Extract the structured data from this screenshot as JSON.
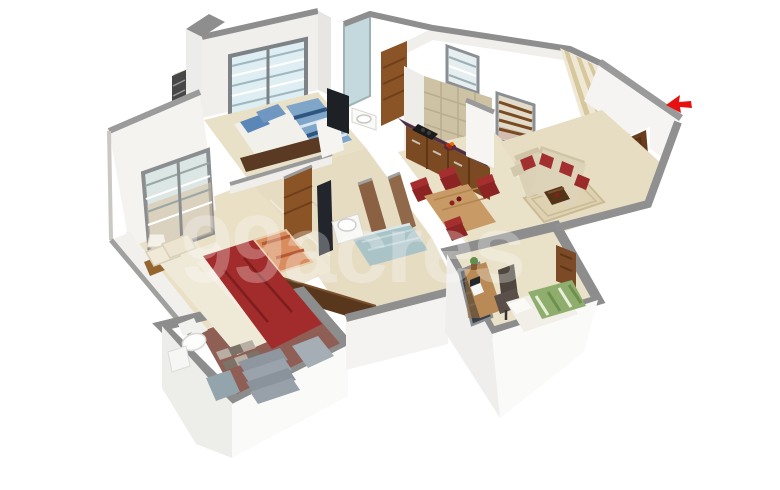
{
  "scene": {
    "description": "3D isometric rendered floor plan of a 2-3 BHK apartment on white background",
    "background": "#ffffff"
  },
  "watermark": {
    "text": "99acres",
    "color": "#ffffff",
    "opacity": "0.28"
  },
  "north_arrow": {
    "color": "#e81111",
    "direction": "left"
  },
  "palette": {
    "wall_top": "#8e8e8e",
    "wall_face": "#f2f1ee",
    "wall_bright": "#fafaf9",
    "floor_beige": "#e9e0c8",
    "floor_dark": "#e3d9bd",
    "wood_door": "#8a5426",
    "wood_dark": "#5a3820",
    "bed_red": "#a22b2b",
    "bed_blue": "#7fa6c9",
    "bed_green": "#8fae6d",
    "sofa_cream": "#dbd1b6",
    "cushion_red": "#a33030",
    "counter_top": "#4e2f40",
    "kitchen_tile": "#cdc2a3",
    "stripe_wall_a": "#efe8d4",
    "stripe_wall_b": "#d6c79c",
    "bath_teal": "#a9c3c6",
    "granite": "#98a1aa",
    "glass_blue": "#dfeef2"
  },
  "rooms": [
    {
      "name": "Bedroom 2",
      "furniture": [
        "double bed with blue striped bedding",
        "blue pillows",
        "TV on white unit",
        "louvered window",
        "balcony with dark railing",
        "washbasin counter"
      ]
    },
    {
      "name": "Kitchen",
      "furniture": [
        "counter with dark stone top",
        "gas stove",
        "fruit bowl",
        "wooden cabinets",
        "beige tiled wall",
        "utility window"
      ]
    },
    {
      "name": "Dining Area",
      "furniture": [
        "wooden four seat dining table",
        "red upholstered chairs"
      ]
    },
    {
      "name": "Living Room",
      "furniture": [
        "cream L-shaped sofa with red cushions",
        "coffee table",
        "rug",
        "striped wallpaper accent wall",
        "open wooden entrance door",
        "balcony window with brown louvers"
      ]
    },
    {
      "name": "Master Bedroom",
      "furniture": [
        "double bed with red blanket",
        "cream pillows",
        "bedside lamp",
        "orange rug",
        "louvered window",
        "wooden door",
        "low wardrobe ledge"
      ]
    },
    {
      "name": "Master Bathroom",
      "furniture": [
        "toilet",
        "checkered tile floor",
        "granite shower steps",
        "washing machine"
      ]
    },
    {
      "name": "Common Bathroom",
      "furniture": [
        "washbasin",
        "wall TV panel",
        "teal shower area",
        "wooden partition walls",
        "teal glass panel",
        "wooden slatted door"
      ]
    },
    {
      "name": "Study Bedroom",
      "furniture": [
        "wooden study desk with computer",
        "office chair",
        "single bed with green striped bedding",
        "potted plant",
        "dark window",
        "wooden door"
      ]
    }
  ]
}
